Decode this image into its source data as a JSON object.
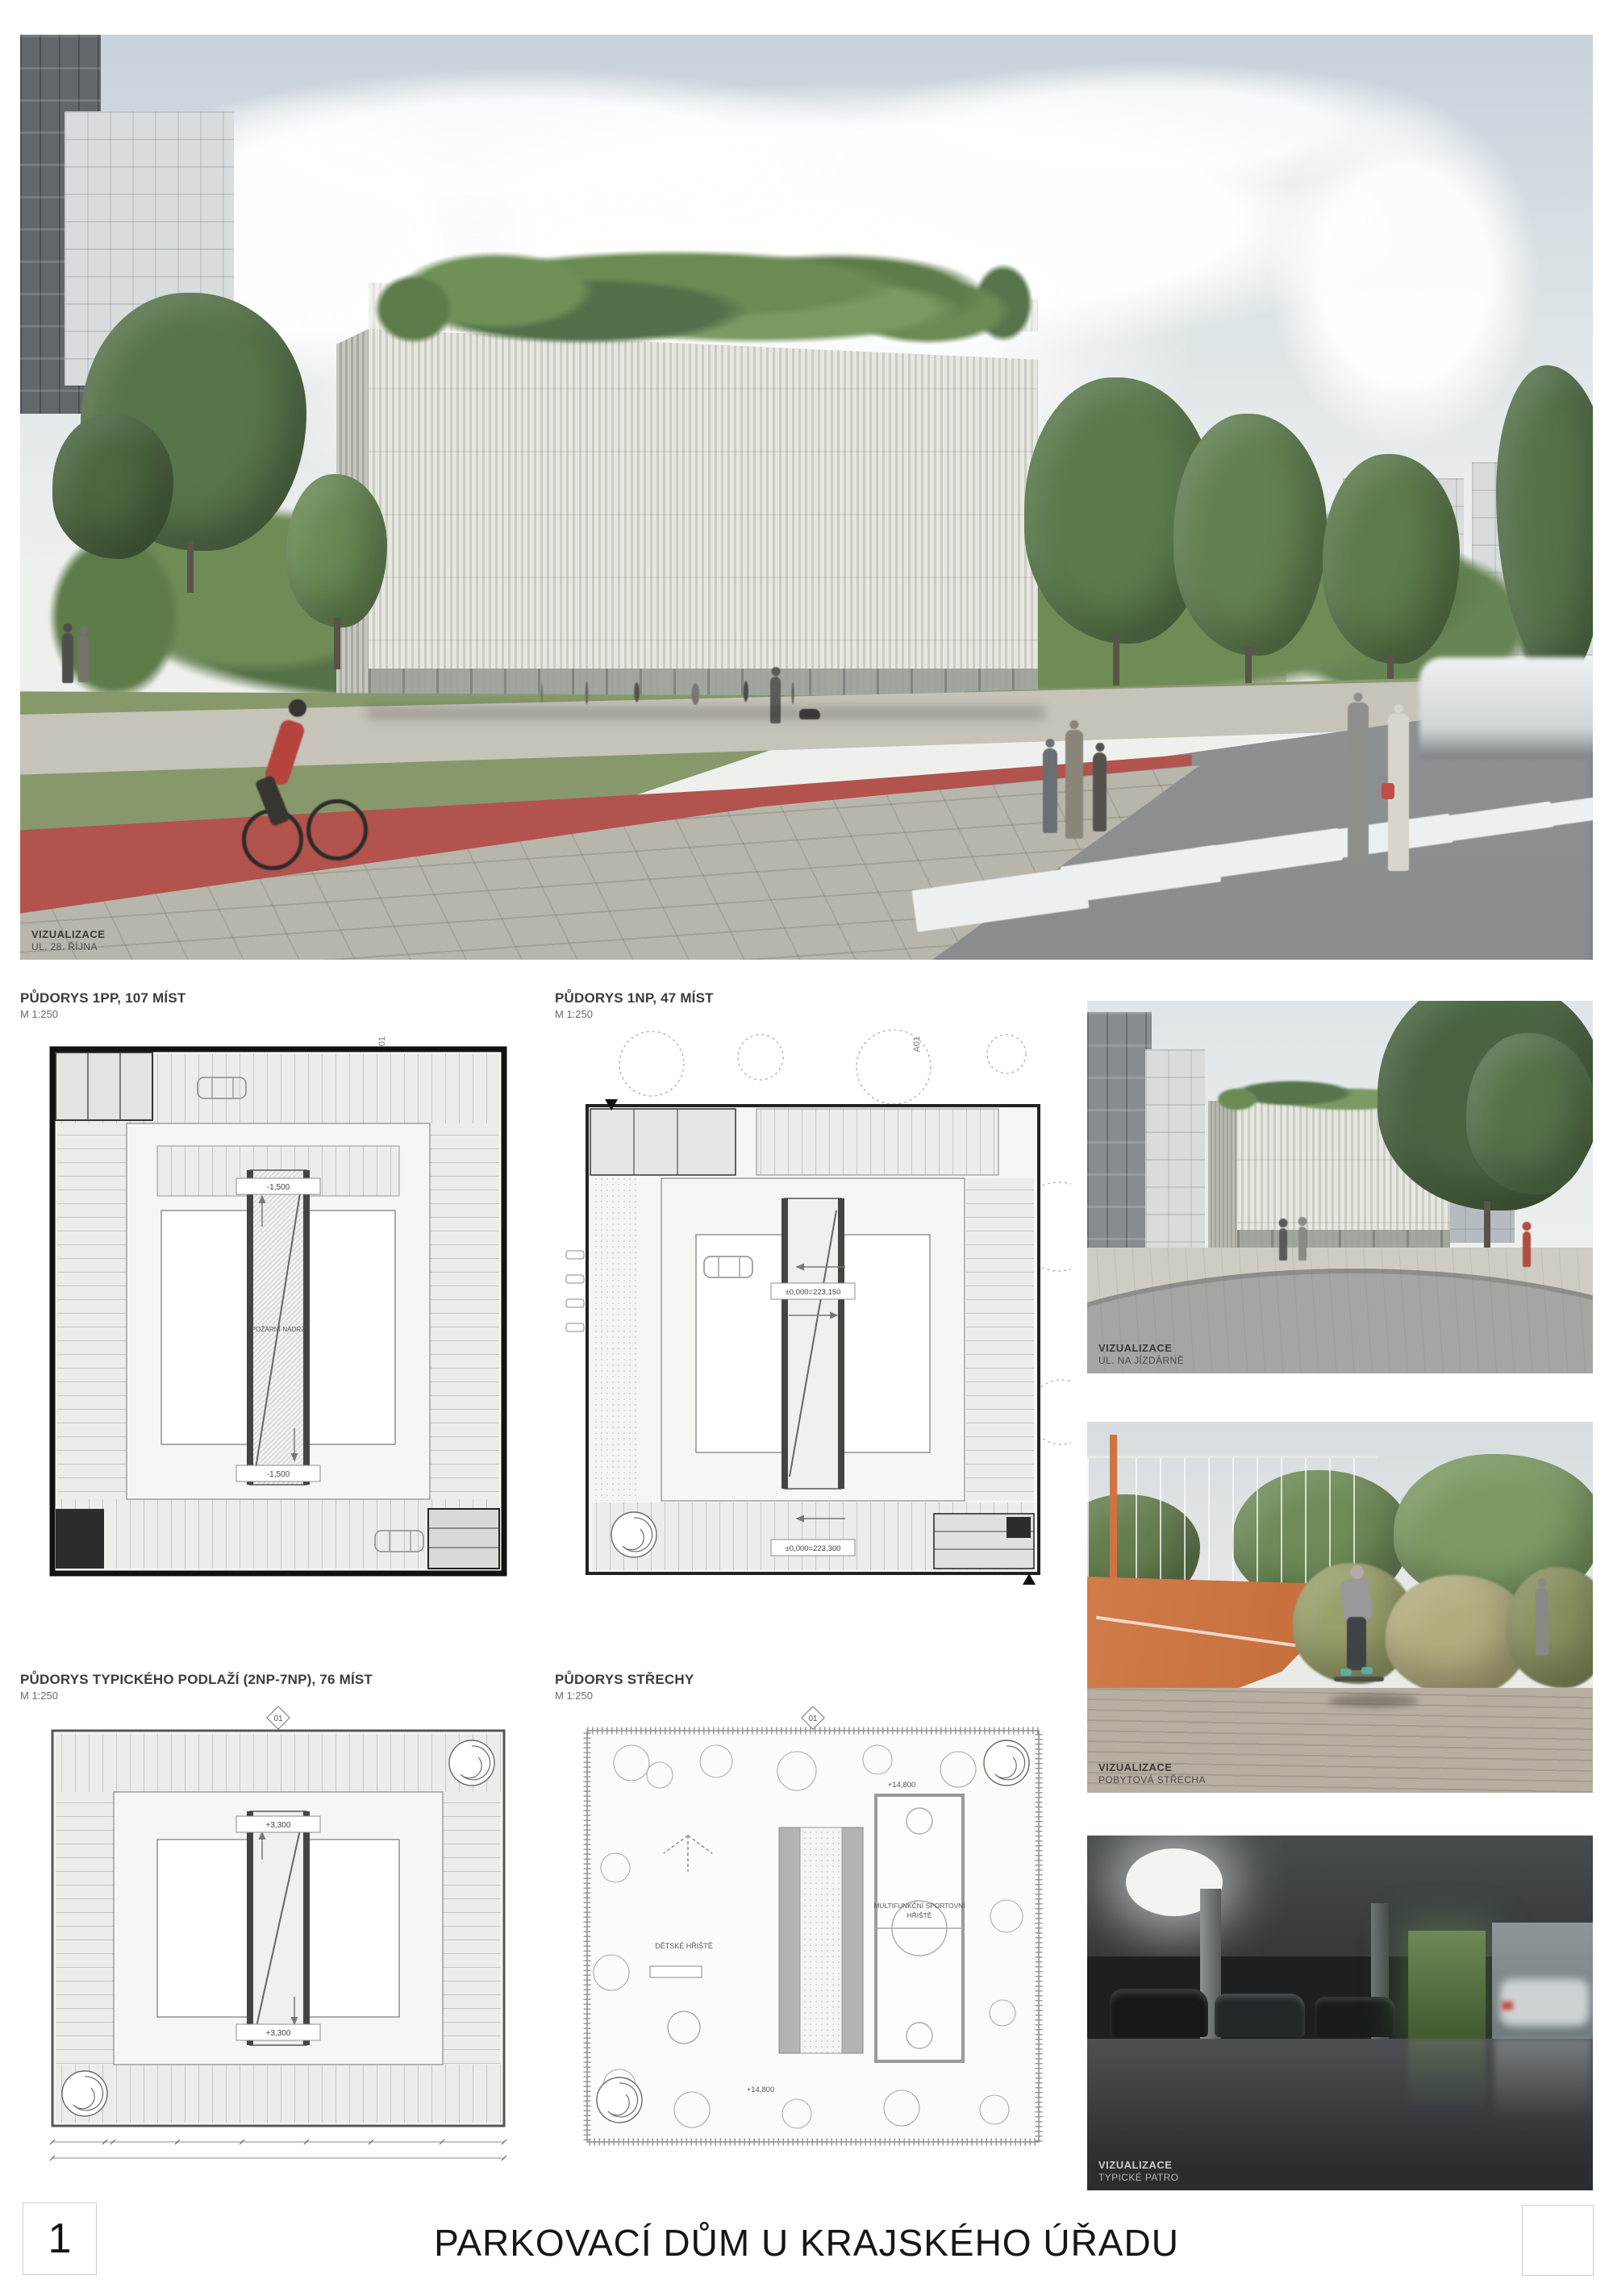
{
  "board": {
    "page_number": "1",
    "title": "PARKOVACÍ DŮM U KRAJSKÉHO ÚŘADU"
  },
  "hero": {
    "caption_title": "VIZUALIZACE",
    "caption_subtitle": "UL. 28. ŘÍJNA"
  },
  "plans": [
    {
      "title": "PŮDORYS 1PP, 107 MÍST",
      "scale": "M 1:250",
      "axis_marker": "A01",
      "level_top": "-1,500",
      "level_bottom": "-1,500",
      "room_label": "POŽÁRNÍ NÁDRŽ"
    },
    {
      "title": "PŮDORYS 1NP, 47 MÍST",
      "scale": "M 1:250",
      "axis_marker": "A01",
      "level_top": "±0,000=223,150",
      "level_bottom": "±0,000=223,300"
    },
    {
      "title": "PŮDORYS TYPICKÉHO PODLAŽÍ (2NP-7NP), 76 MÍST",
      "scale": "M 1:250",
      "section_marker": "01",
      "level_top": "+3,300",
      "level_bottom": "+3,300"
    },
    {
      "title": "PŮDORYS STŘECHY",
      "scale": "M 1:250",
      "section_marker": "01",
      "level_top": "+14,800",
      "level_bottom": "+14,800",
      "playground_label": "DĚTSKÉ HŘIŠTĚ",
      "court_label_line1": "MULTIFUNKČNÍ SPORTOVNÍ",
      "court_label_line2": "HŘIŠTĚ"
    }
  ],
  "visualizations": [
    {
      "caption_title": "VIZUALIZACE",
      "caption_subtitle": "UL. NA JÍZDÁRNĚ"
    },
    {
      "caption_title": "VIZUALIZACE",
      "caption_subtitle": "POBYTOVÁ STŘECHA"
    },
    {
      "caption_title": "VIZUALIZACE",
      "caption_subtitle": "TYPICKÉ PATRO"
    }
  ],
  "colors": {
    "bike_path_red": "#b2534e",
    "court_orange": "#c8713f",
    "roof_green": "#6b8a54",
    "plan_line": "#555555"
  }
}
